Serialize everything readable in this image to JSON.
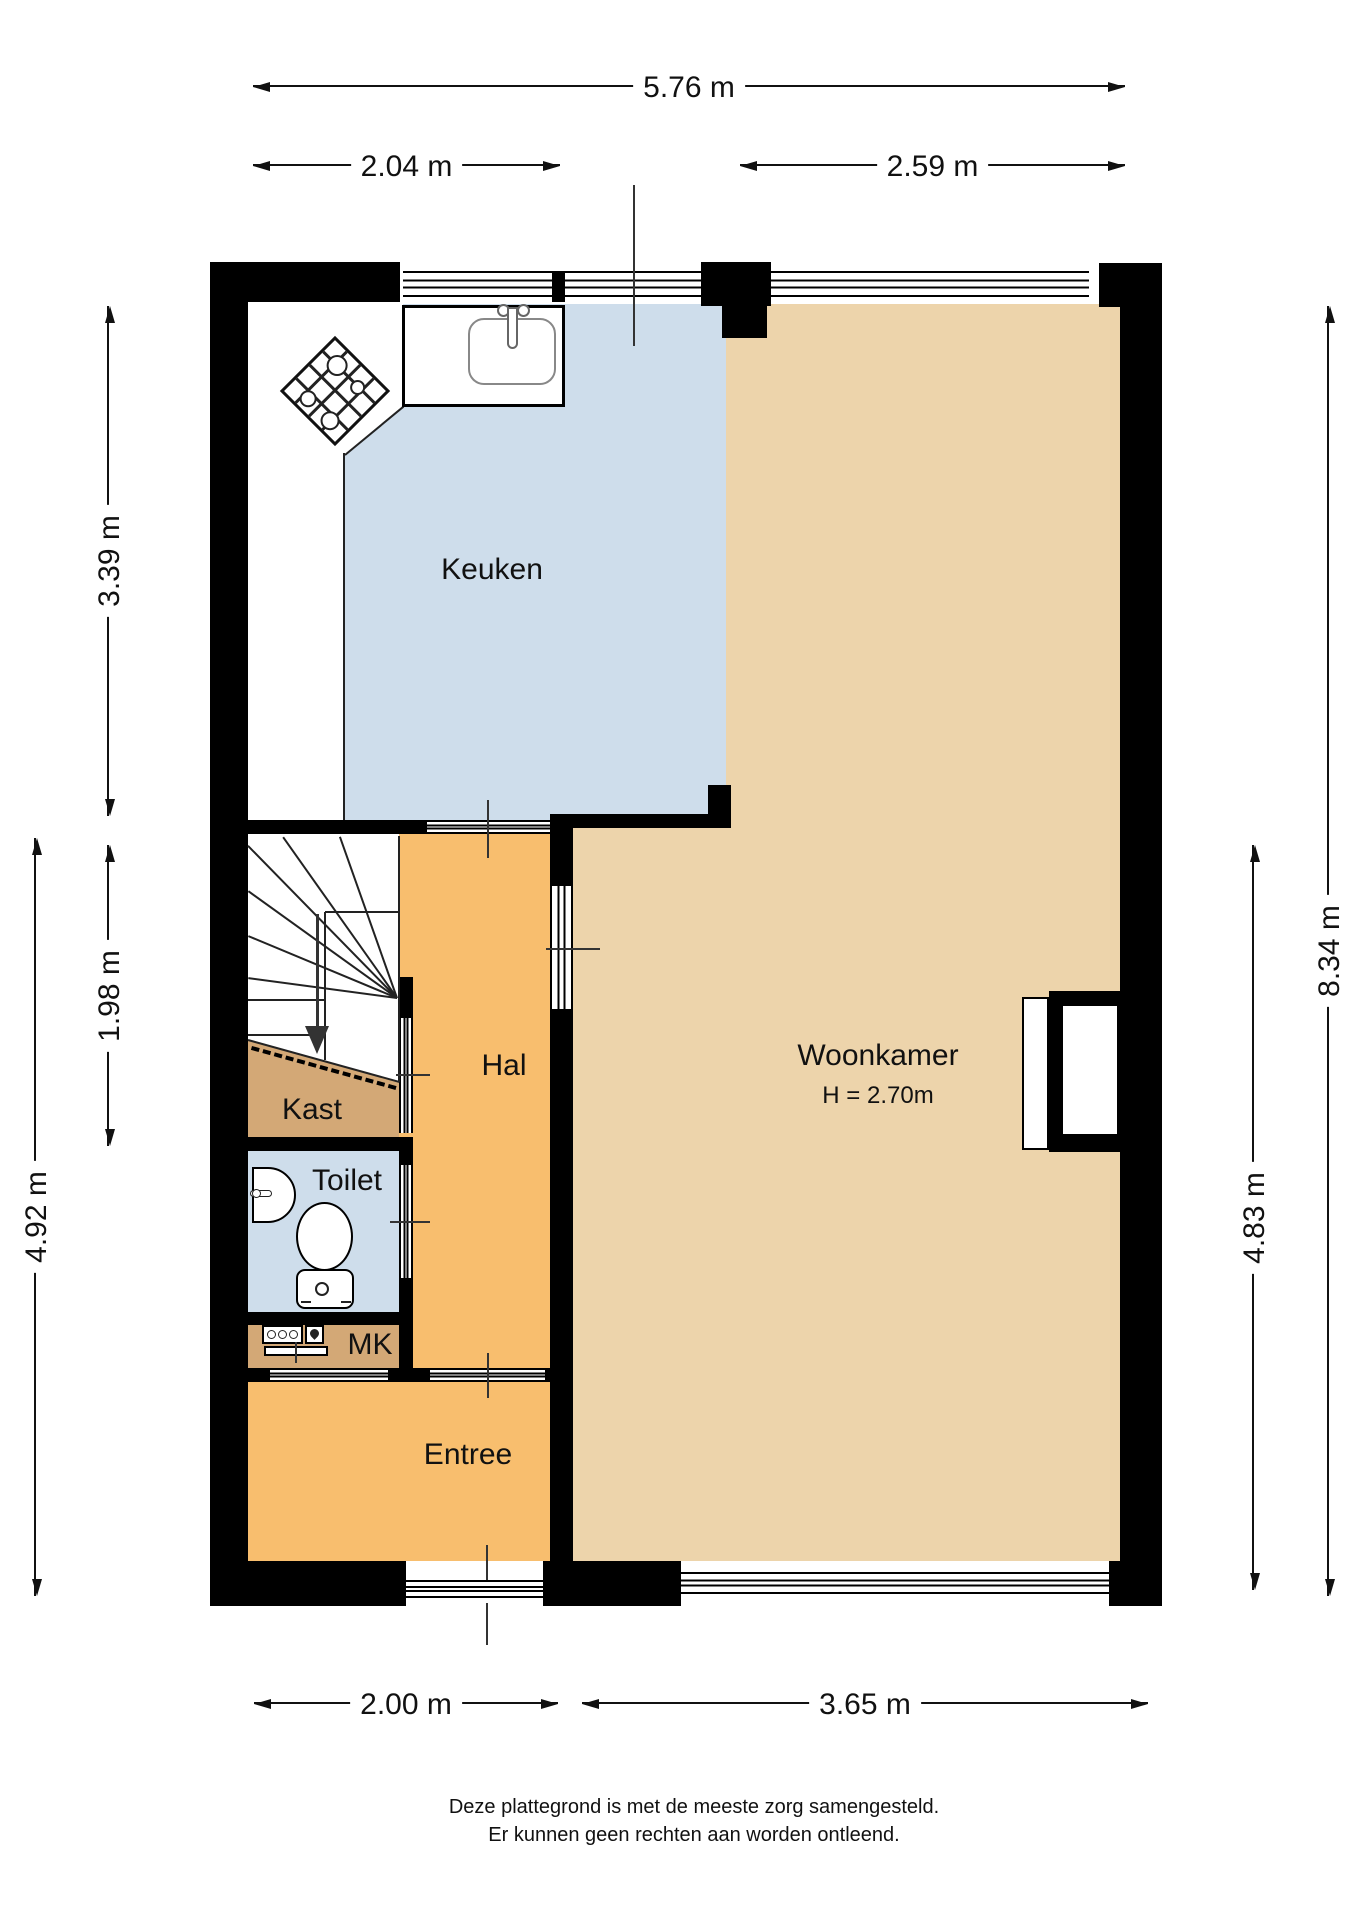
{
  "plan": {
    "rooms": {
      "keuken": {
        "label": "Keuken"
      },
      "woonkamer": {
        "label": "Woonkamer",
        "height_note": "H = 2.70m"
      },
      "hal": {
        "label": "Hal"
      },
      "kast": {
        "label": "Kast"
      },
      "toilet": {
        "label": "Toilet"
      },
      "mk": {
        "label": "MK"
      },
      "entree": {
        "label": "Entree"
      }
    },
    "dimensions": {
      "top_total": "5.76 m",
      "top_left": "2.04 m",
      "top_right": "2.59 m",
      "left_kitchen": "3.39 m",
      "left_stairs": "1.98 m",
      "left_total": "4.92 m",
      "right_living": "4.83 m",
      "right_total": "8.34 m",
      "bottom_left": "2.00 m",
      "bottom_right": "3.65 m"
    },
    "footer": {
      "line1": "Deze plattegrond is met de meeste zorg samengesteld.",
      "line2": "Er kunnen geen rechten aan worden ontleend."
    },
    "colors": {
      "wall": "#000000",
      "floor-kitchen": "#CEDDEB",
      "floor-toilet": "#CEDDEB",
      "floor-living": "#EDD4AB",
      "floor-hall": "#F8BE6E",
      "floor-closet": "#D3A876"
    },
    "icons": {
      "stove": "gas-hob-icon",
      "sink": "kitchen-sink-icon",
      "wc": "toilet-icon",
      "washbasin": "washbasin-icon",
      "meters": "utility-meter-icon",
      "stairs": "staircase-icon",
      "chimney": "chimney-breast-icon"
    }
  }
}
